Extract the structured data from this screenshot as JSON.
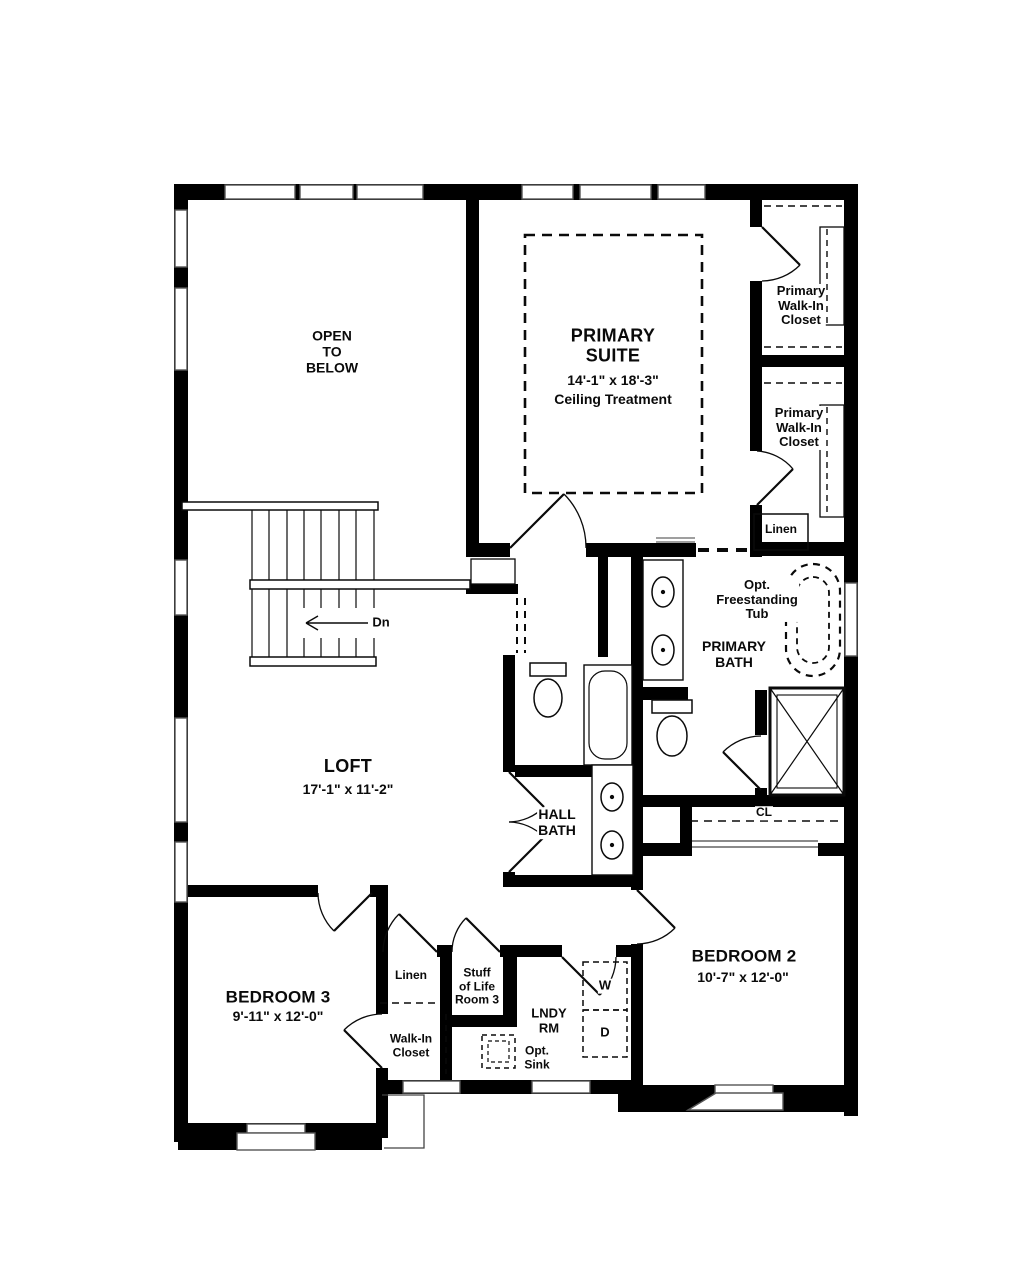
{
  "rooms": {
    "openBelow": {
      "label": "OPEN\nTO\nBELOW"
    },
    "primarySuite": {
      "name": "PRIMARY\nSUITE",
      "dims": "14'-1\" x 18'-3\"",
      "note": "Ceiling Treatment"
    },
    "wicUpper": {
      "label": "Primary\nWalk-In\nCloset"
    },
    "wicLower": {
      "label": "Primary\nWalk-In\nCloset"
    },
    "linenUpper": {
      "label": "Linen"
    },
    "primaryBath": {
      "name": "PRIMARY\nBATH",
      "tubNote": "Opt.\nFreestanding\nTub"
    },
    "stairs": {
      "downLabel": "Dn"
    },
    "loft": {
      "name": "LOFT",
      "dims": "17'-1\" x 11'-2\""
    },
    "hallBath": {
      "name": "HALL\nBATH"
    },
    "bedroom2Closet": {
      "label": "CL"
    },
    "bedroom2": {
      "name": "BEDROOM 2",
      "dims": "10'-7\" x 12'-0\""
    },
    "bedroom3": {
      "name": "BEDROOM 3",
      "dims": "9'-11\" x 12'-0\""
    },
    "linenLower": {
      "label": "Linen"
    },
    "stuffOfLife": {
      "label": "Stuff\nof Life\nRoom 3"
    },
    "walkInCloset": {
      "label": "Walk-In\nCloset"
    },
    "laundry": {
      "name": "LNDY\nRM",
      "washer": "W",
      "dryer": "D",
      "sinkNote": "Opt.\nSink"
    }
  },
  "colors": {
    "wall": "#000000",
    "background": "#ffffff"
  }
}
